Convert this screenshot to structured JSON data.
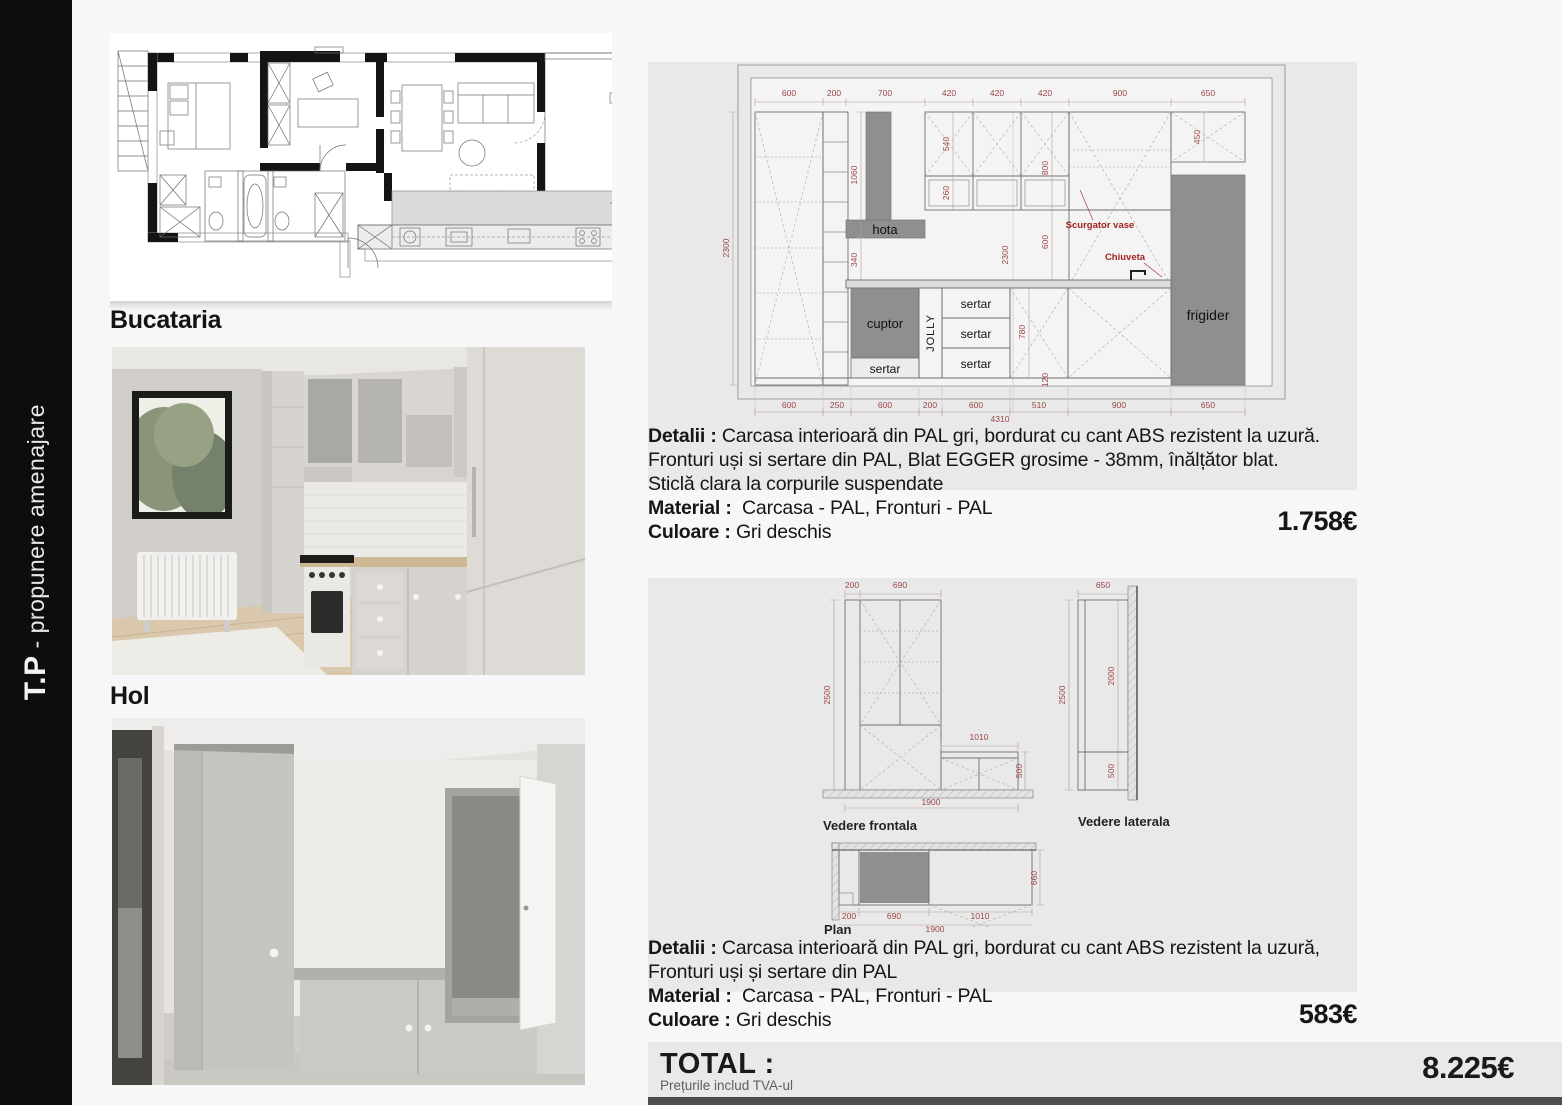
{
  "sidebar": {
    "brand": "T.P",
    "subtitle": " - propunere amenajare"
  },
  "headings": {
    "kitchen": "Bucataria",
    "hall": "Hol"
  },
  "kitchen_drawing": {
    "top_dims": [
      "600",
      "200",
      "700",
      "420",
      "420",
      "420",
      "900",
      "650"
    ],
    "bottom_dims": [
      "600",
      "250",
      "600",
      "200",
      "600",
      "510",
      "900",
      "650"
    ],
    "overall_width": "4310",
    "left_height": "2300",
    "v_dims": {
      "hota_col": "1060",
      "upper": "540",
      "glass": "260",
      "upper_total": "800",
      "fridge_top": "450",
      "below_hood": "340",
      "mid_height": "2300",
      "splash": "600",
      "base": "780",
      "plinth": "120"
    },
    "labels": {
      "hota": "hota",
      "cuptor": "cuptor",
      "jolly": "JOLLY",
      "sertar": "sertar",
      "frigider": "frigider",
      "scurgator": "Scurgator vase",
      "chiuveta": "Chiuveta"
    }
  },
  "hall_drawing": {
    "front": {
      "label": "Vedere frontala",
      "w_side": "200",
      "w_door": "690",
      "height": "2500",
      "bench_w": "1010",
      "bench_h": "500",
      "total_w": "1900"
    },
    "side": {
      "label": "Vedere laterala",
      "depth": "650",
      "height": "2500",
      "upper": "2000",
      "lower": "500"
    },
    "plan": {
      "label": "Plan",
      "w_side": "200",
      "w_door": "690",
      "bench_w": "1010",
      "total_w": "1900",
      "depth": "660"
    }
  },
  "block1": {
    "detalii_label": "Detalii :",
    "detalii_1": "Carcasa interioară din PAL gri, bordurat cu cant ABS rezistent la uzură.",
    "detalii_2": "Fronturi uși si sertare din PAL, Blat EGGER grosime - 38mm, înălțător blat.",
    "detalii_3": "Sticlă clara la corpurile suspendate",
    "material_label": "Material :",
    "material_value": "Carcasa - PAL, Fronturi - PAL",
    "culoare_label": "Culoare :",
    "culoare_value": "Gri deschis",
    "price": "1.758€"
  },
  "block2": {
    "detalii_label": "Detalii :",
    "detalii_1": "Carcasa interioară din PAL gri, bordurat cu cant ABS rezistent la uzură,",
    "detalii_2": "Fronturi uși și sertare din PAL",
    "material_label": "Material :",
    "material_value": "Carcasa - PAL, Fronturi - PAL",
    "culoare_label": "Culoare :",
    "culoare_value": "Gri deschis",
    "price": "583€"
  },
  "total": {
    "label": "TOTAL :",
    "note": "Prețurile includ TVA-ul",
    "price": "8.225€"
  },
  "colors": {
    "dim_red": "#9c4545",
    "label_red": "#a32222",
    "panel_gray": "#e9e9e9",
    "block_gray": "#8f8f8f"
  }
}
